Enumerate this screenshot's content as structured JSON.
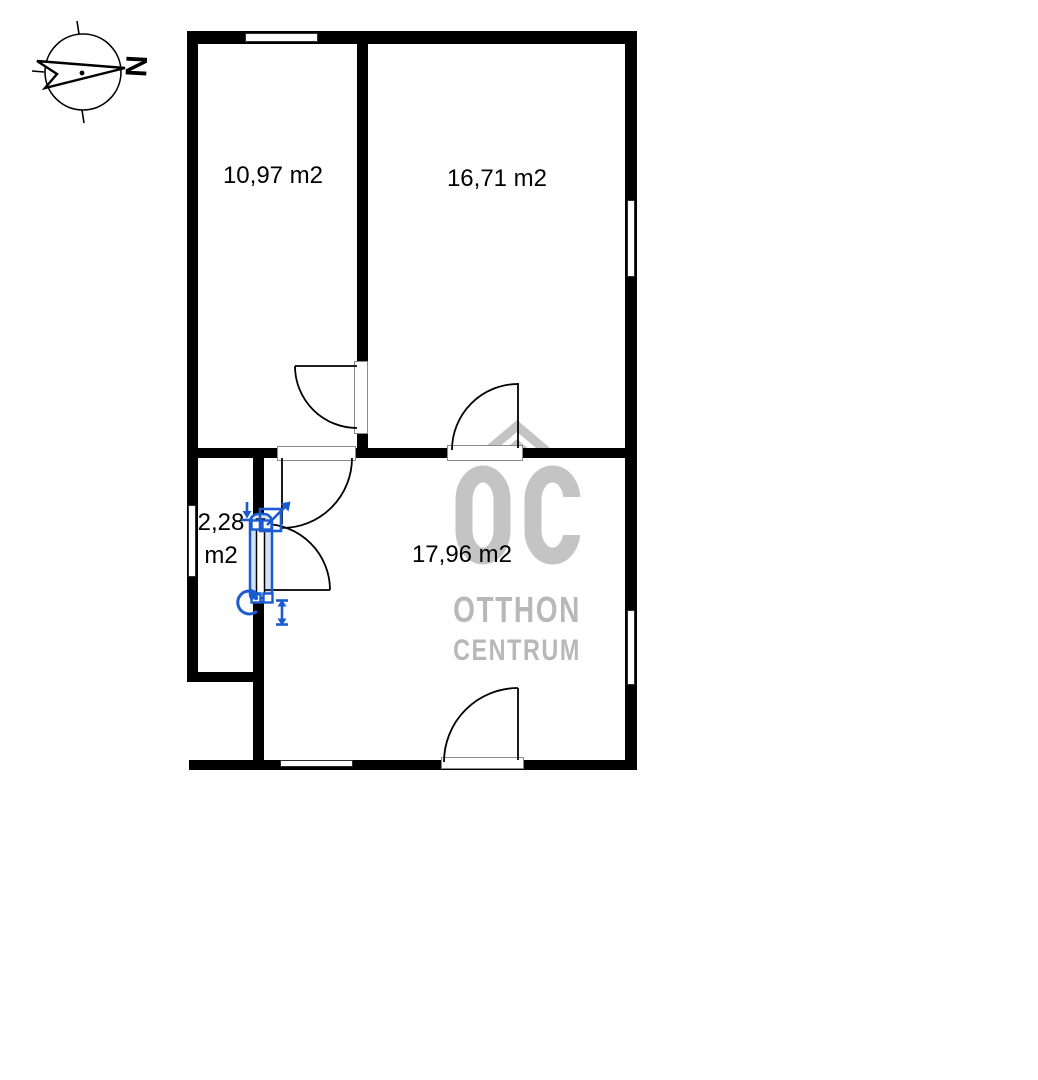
{
  "compass": {
    "north_letter": "N"
  },
  "rooms": [
    {
      "id": "room-1",
      "area": "10,97 m2"
    },
    {
      "id": "room-2",
      "area": "16,71 m2"
    },
    {
      "id": "room-3",
      "area_line1": "2,28",
      "area_line2": "m2"
    },
    {
      "id": "room-4",
      "area": "17,96 m2"
    }
  ],
  "watermark": {
    "monogram": "OC",
    "name_line1": "OTTHON",
    "name_line2": "CENTRUM"
  },
  "icons": {
    "compass_rose": "north-arrow-pointing-right",
    "move_down_icon": "arrow-down-to-bar",
    "resize_diagonal_icon": "arrow-up-right-box",
    "rotate_icon": "rotate-counterclockwise-arrow",
    "resize_vertical_icon": "double-headed-vertical-arrow"
  },
  "colors": {
    "background": "#ffffff",
    "wall": "#000000",
    "door_line": "#000000",
    "selection_blue": "#1a5bd0",
    "selection_fill": "rgba(23,87,208,0.18)",
    "watermark_gray": "#c4c4c4",
    "watermark_text_gray": "#b8b8b8"
  }
}
